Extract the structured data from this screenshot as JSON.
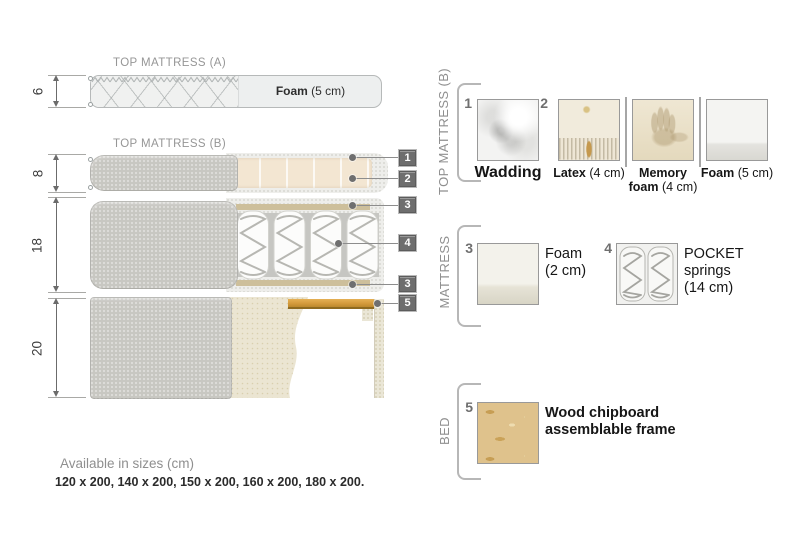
{
  "diagram": {
    "mattress_a": {
      "title": "TOP MATTRESS (A)",
      "dim": "6",
      "foam_name": "Foam",
      "foam_size": " (5 cm)"
    },
    "mattress_b": {
      "title": "TOP MATTRESS (B)",
      "dim": "8"
    },
    "mattress_core": {
      "dim": "18"
    },
    "bed_base": {
      "dim": "20"
    },
    "callouts": [
      "1",
      "2",
      "3",
      "4",
      "3",
      "5"
    ]
  },
  "legend": {
    "sections": [
      {
        "title": "TOP MATTRESS (B)",
        "items": [
          {
            "num": "1",
            "name": "Wadding",
            "size": ""
          },
          {
            "num": "2",
            "name": "Latex",
            "size": " (4 cm)"
          },
          {
            "num": "",
            "name": "Memory foam",
            "size": " (4 cm)"
          },
          {
            "num": "",
            "name": "Foam",
            "size": " (5 cm)"
          }
        ]
      },
      {
        "title": "MATTRESS",
        "items": [
          {
            "num": "3",
            "name": "Foam",
            "size": "(2 cm)"
          },
          {
            "num": "4",
            "name": "POCKET springs",
            "size": "(14 cm)"
          }
        ]
      },
      {
        "title": "BED",
        "items": [
          {
            "num": "5",
            "name": "Wood chipboard assemblable frame",
            "size": ""
          }
        ]
      }
    ]
  },
  "footer": {
    "title": "Available in sizes (cm)",
    "sizes": "120 x 200, 140 x 200, 150 x 200, 160 x 200, 180 x 200."
  },
  "colors": {
    "fabric_gray": "#c8c7c2",
    "foam_beige": "#f3e6d2",
    "wood": "#d49b3c",
    "callout_bg": "#6e6e6e",
    "muted_text": "#8f8f8f"
  }
}
